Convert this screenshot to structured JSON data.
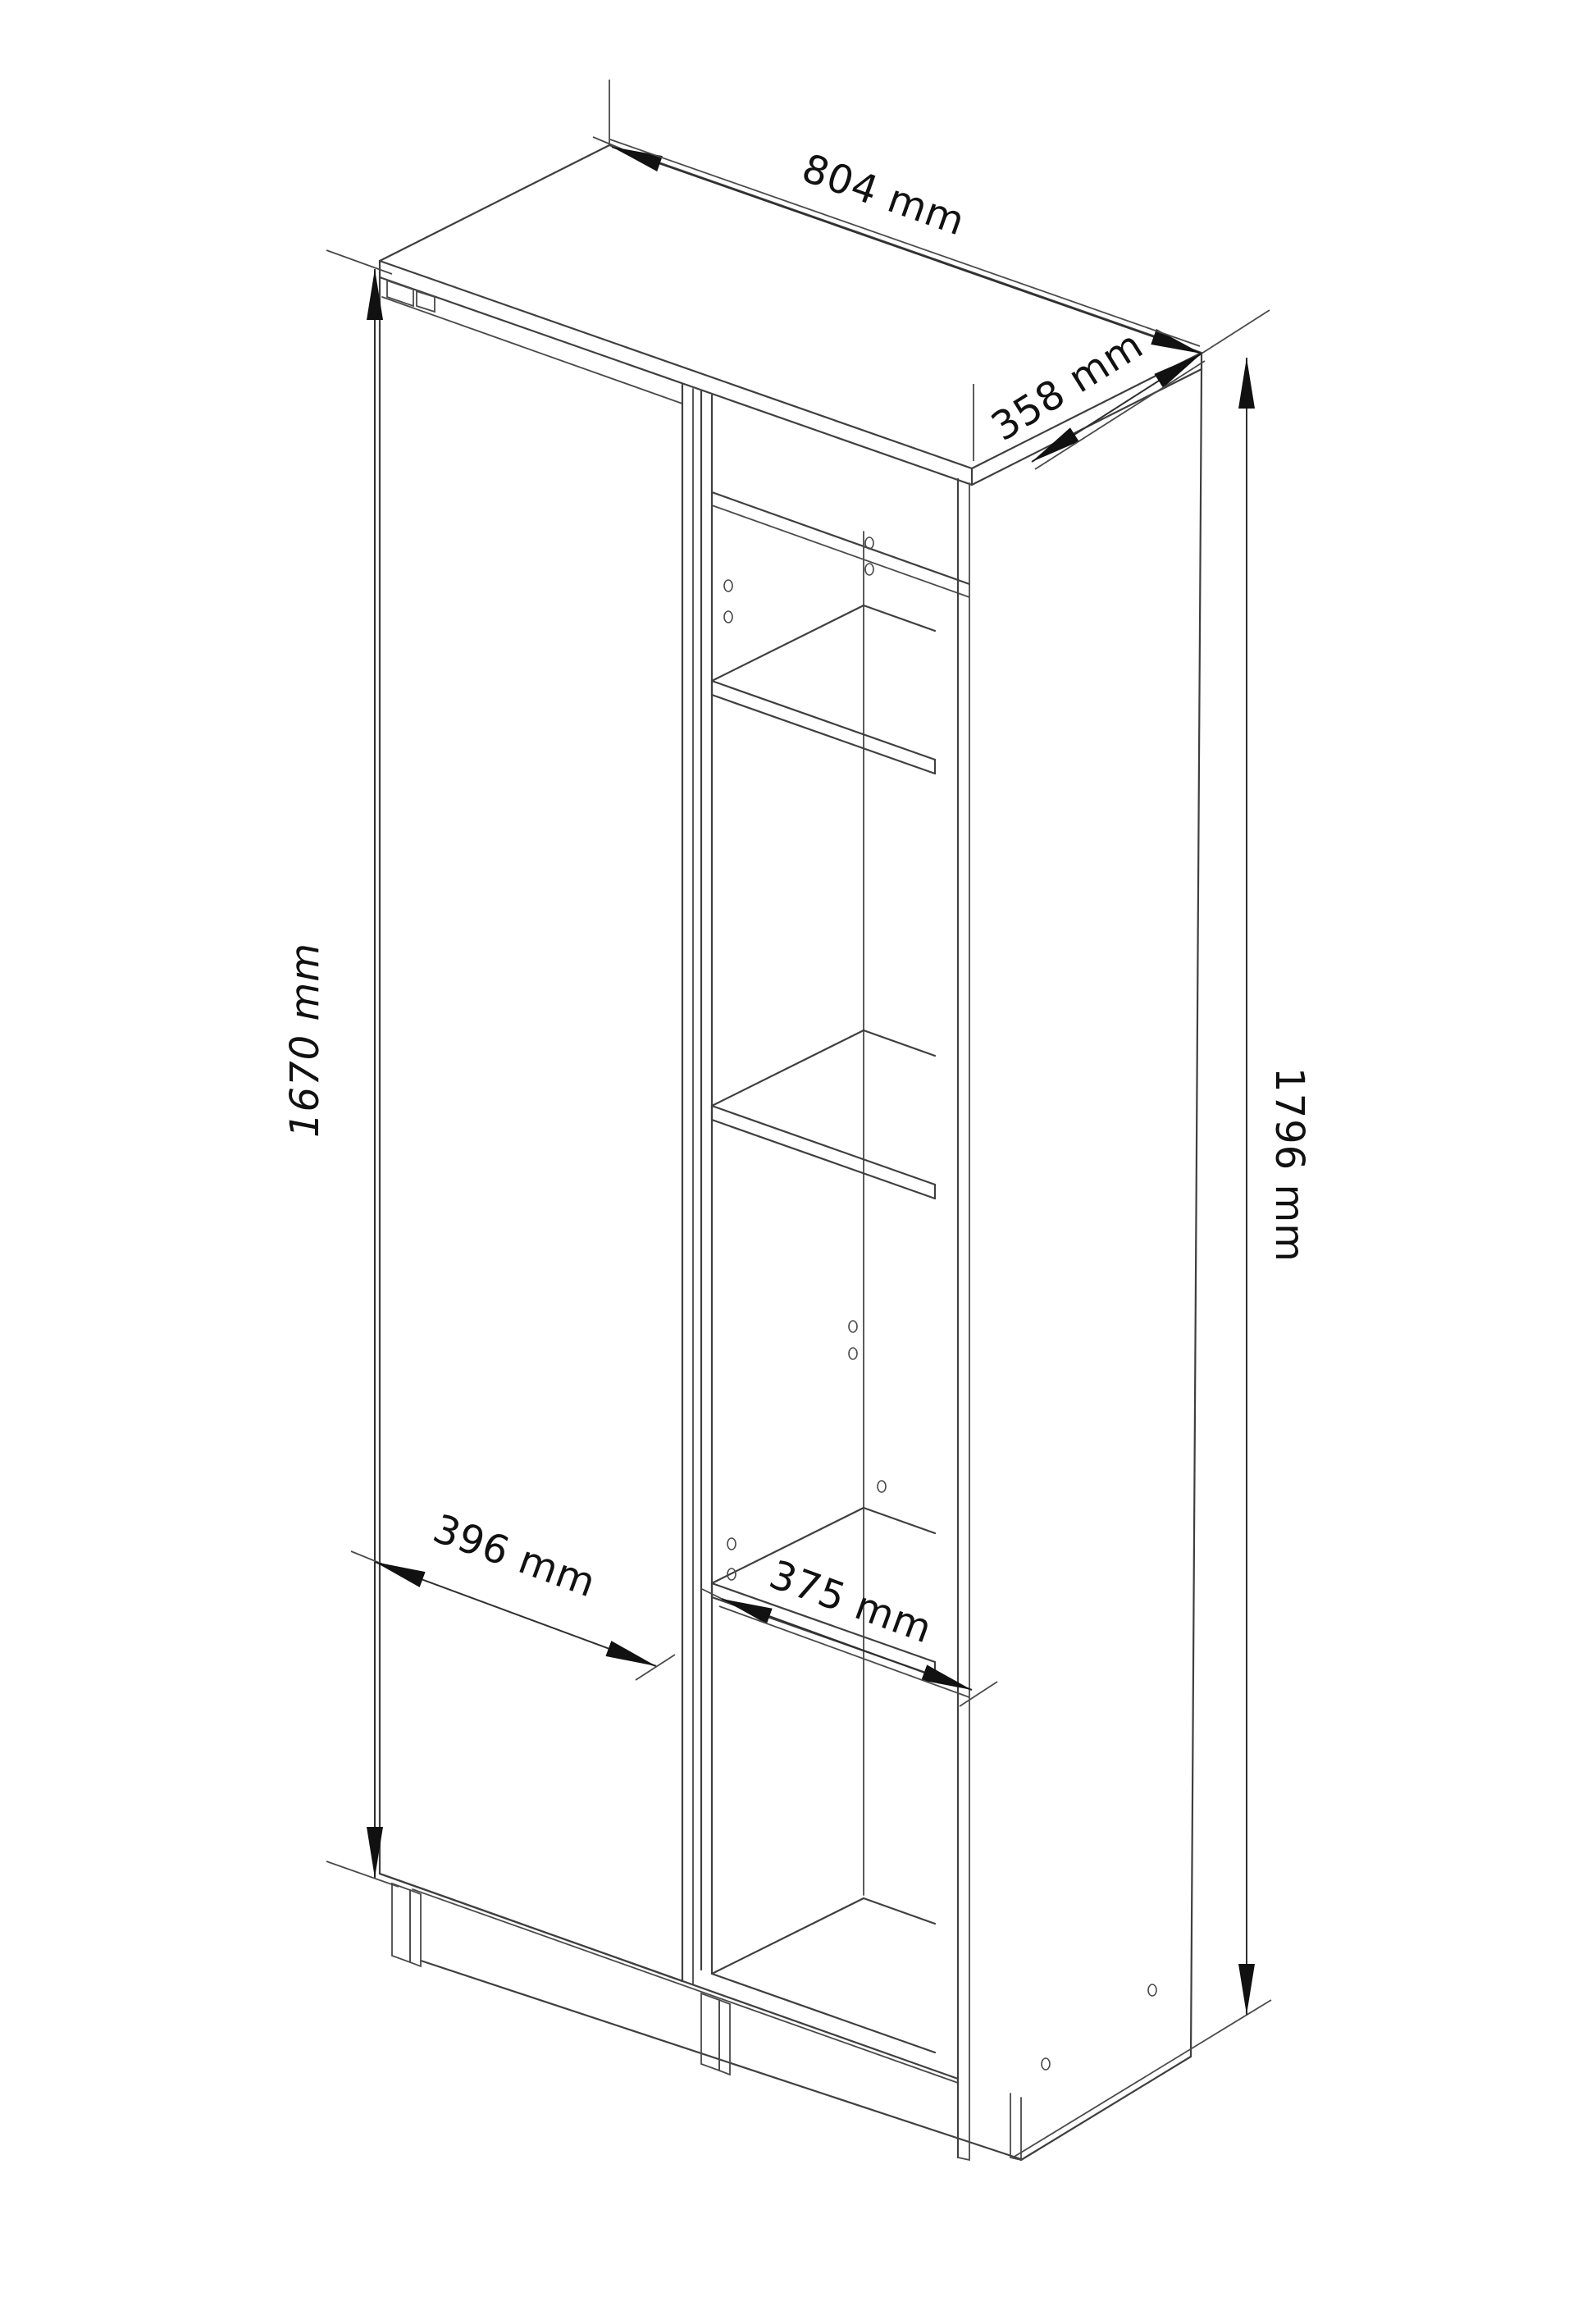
{
  "title": "Wardrobe technical dimension drawing",
  "drawing": {
    "kind": "isometric furniture line drawing",
    "object": "tall two-section cabinet with left hinged door and right open shelving",
    "background_color": "#ffffff",
    "line_color": "#3f3f3f",
    "arrow_color": "#111111",
    "text_color": "#111111"
  },
  "dimensions": {
    "overall_width": {
      "label": "804 mm",
      "value": 804,
      "unit": "mm"
    },
    "overall_depth": {
      "label": "358 mm",
      "value": 358,
      "unit": "mm"
    },
    "overall_height": {
      "label": "1796 mm",
      "value": 1796,
      "unit": "mm"
    },
    "door_height": {
      "label": "1670 mm",
      "value": 1670,
      "unit": "mm"
    },
    "door_width": {
      "label": "396 mm",
      "value": 396,
      "unit": "mm"
    },
    "shelf_width": {
      "label": "375 mm",
      "value": 375,
      "unit": "mm"
    }
  },
  "features": {
    "shelf_count": 3,
    "door_count": 1,
    "legs_visible": 2,
    "drill_holes_visible": true
  }
}
